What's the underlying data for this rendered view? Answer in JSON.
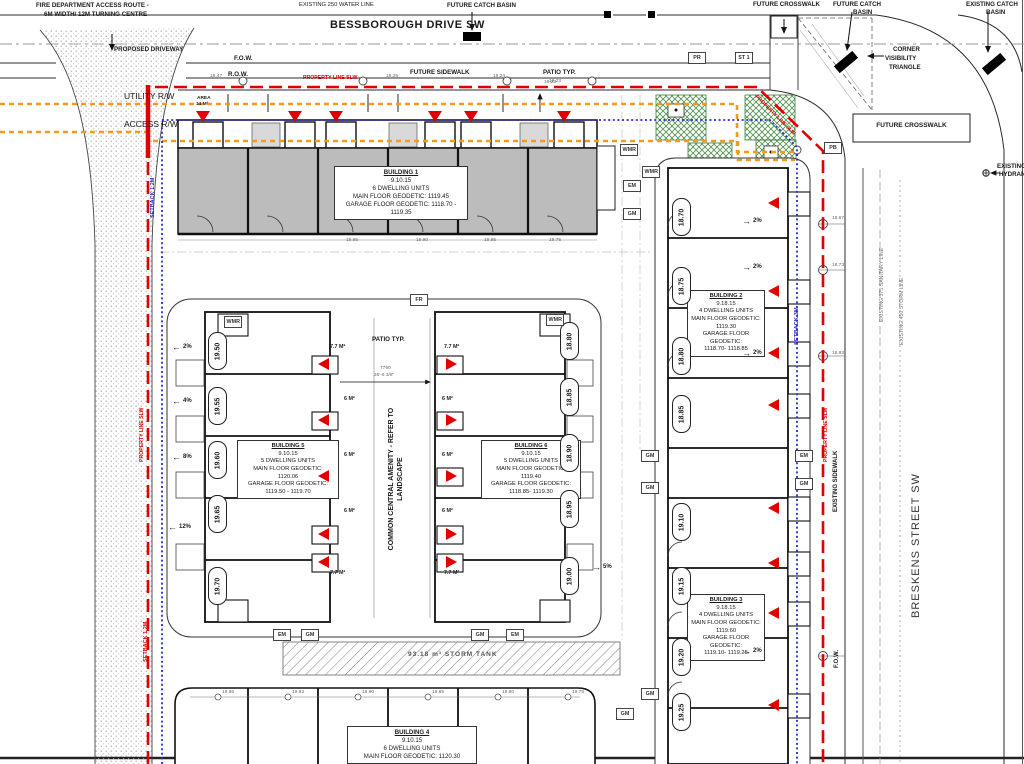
{
  "colors": {
    "property_line": "#e00000",
    "setback_line": "#2a2ad0",
    "rw_line": "#f29a22",
    "building_fill": "#bcbcbc",
    "landscape": "#4d8f4d"
  },
  "streets": {
    "bessborough": "BESSBOROUGH DRIVE SW",
    "breskens": "BRESKENS STREET SW"
  },
  "labels": {
    "fire1": "FIRE DEPARTMENT ACCESS ROUTE -",
    "fire2": "6M WIDTH/ 12M TURNING CENTRE",
    "water": "EXISTING 250 WATER LINE",
    "fcb_top": "FUTURE CATCH BASIN",
    "fcw_top": "FUTURE CROSSWALK",
    "fcb_r1": "FUTURE CATCH",
    "fcb_r2": "BASIN",
    "ecb1": "EXISTING CATCH",
    "ecb2": "BASIN",
    "drive": "PROPOSED DRIVEWAY",
    "cvt1": "CORNER",
    "cvt2": "VISIBILITY",
    "cvt3": "TRIANGLE",
    "fow": "F.O.W.",
    "row": "R.O.W.",
    "fsw": "FUTURE SIDEWALK",
    "patio_top": "PATIO TYP.",
    "patio_elev": "19.23",
    "pl_slw": "PROPERTY LINE SLW",
    "utility": "UTILITY R/W",
    "access": "ACCESS R/W",
    "fcw_right": "FUTURE CROSSWALK",
    "hyd1": "EXISTING",
    "hyd2": "HYDRANT",
    "setback12": "SETBACK 1.2M",
    "setback3": "SETBACK 3M",
    "exist_sw": "EXISTING SIDEWALK",
    "fow2": "F.O.W.",
    "sanitary": "EXISTING 375 SANITARY LINE",
    "stormline": "EXISTING 450 STORM LINE",
    "amen1": "COMMON CENTRAL AMENITY -",
    "amen2": "REFER TO LANDSCAPE",
    "patio_c": "PATIO TYP.",
    "tank": "93.18 m³ STORM TANK",
    "area1": "AREA",
    "area2": "14 M²",
    "dim1": "7790",
    "dim2": "26'-6 3/8\""
  },
  "buildings": {
    "b1": [
      "BUILDING 1",
      "9.10.15",
      "6 DWELLING UNITS",
      "MAIN FLOOR GEODETIC: 1119.45",
      "GARAGE FLOOR GEODETIC: 1118.70 - 1119.35"
    ],
    "b2": [
      "BUILDING 2",
      "9.18.15",
      "4 DWELLING UNITS",
      "MAIN FLOOR GEODETIC:",
      "1119.30",
      "GARAGE FLOOR GEODETIC:",
      "1118.70- 1118.85"
    ],
    "b3": [
      "BUILDING 3",
      "9.18.15",
      "4 DWELLING UNITS",
      "MAIN FLOOR GEODETIC:",
      "1119.60",
      "GARAGE FLOOR GEODETIC:",
      "1119.10- 1119.25"
    ],
    "b4": [
      "BUILDING 4",
      "9.10.15",
      "6 DWELLING UNITS",
      "MAIN FLOOR GEODETIC: 1120.30"
    ],
    "b5": [
      "BUILDING 5",
      "9.10.15",
      "5 DWELLING UNITS",
      "MAIN FLOOR GEODETIC:",
      "1120.06",
      "GARAGE FLOOR GEODETIC:",
      "1119.50 - 1119.70"
    ],
    "b6": [
      "BUILDING 6",
      "9.10.15",
      "5 DWELLING UNITS",
      "MAIN FLOOR GEODETIC:",
      "1119.40",
      "GARAGE FLOOR GEODETIC:",
      "1118.85- 1119.30"
    ]
  },
  "spot_elevations": [
    {
      "v": "19.50",
      "x": 208,
      "y": 332
    },
    {
      "v": "19.55",
      "x": 208,
      "y": 387
    },
    {
      "v": "19.60",
      "x": 208,
      "y": 441
    },
    {
      "v": "19.65",
      "x": 208,
      "y": 495
    },
    {
      "v": "19.70",
      "x": 208,
      "y": 567
    },
    {
      "v": "18.80",
      "x": 560,
      "y": 322
    },
    {
      "v": "18.85",
      "x": 560,
      "y": 378
    },
    {
      "v": "18.90",
      "x": 560,
      "y": 434
    },
    {
      "v": "18.95",
      "x": 560,
      "y": 490
    },
    {
      "v": "19.00",
      "x": 560,
      "y": 557
    },
    {
      "v": "18.70",
      "x": 672,
      "y": 198
    },
    {
      "v": "18.75",
      "x": 672,
      "y": 267
    },
    {
      "v": "18.80",
      "x": 672,
      "y": 337
    },
    {
      "v": "18.85",
      "x": 672,
      "y": 395
    },
    {
      "v": "19.10",
      "x": 672,
      "y": 503
    },
    {
      "v": "19.15",
      "x": 672,
      "y": 567
    },
    {
      "v": "19.20",
      "x": 672,
      "y": 638
    },
    {
      "v": "19.25",
      "x": 672,
      "y": 693
    }
  ],
  "utility_boxes": [
    {
      "v": "PR",
      "x": 688,
      "y": 52
    },
    {
      "v": "ST 1",
      "x": 735,
      "y": 52
    },
    {
      "v": "PB",
      "x": 824,
      "y": 142
    },
    {
      "v": "FR",
      "x": 410,
      "y": 294
    },
    {
      "v": "WMR",
      "x": 620,
      "y": 144
    },
    {
      "v": "WMR",
      "x": 642,
      "y": 166
    },
    {
      "v": "EM",
      "x": 623,
      "y": 180
    },
    {
      "v": "GM",
      "x": 623,
      "y": 208
    },
    {
      "v": "WMR",
      "x": 224,
      "y": 316
    },
    {
      "v": "WMR",
      "x": 546,
      "y": 314
    },
    {
      "v": "EM",
      "x": 273,
      "y": 629
    },
    {
      "v": "GM",
      "x": 301,
      "y": 629
    },
    {
      "v": "GM",
      "x": 471,
      "y": 629
    },
    {
      "v": "EM",
      "x": 506,
      "y": 629
    },
    {
      "v": "GM",
      "x": 641,
      "y": 450
    },
    {
      "v": "GM",
      "x": 641,
      "y": 482
    },
    {
      "v": "EM",
      "x": 795,
      "y": 450
    },
    {
      "v": "GM",
      "x": 795,
      "y": 478
    },
    {
      "v": "GM",
      "x": 616,
      "y": 708
    },
    {
      "v": "GM",
      "x": 641,
      "y": 688
    }
  ],
  "slope_arrows": [
    {
      "v": "2%",
      "x": 172,
      "y": 344,
      "cls": "slope-left"
    },
    {
      "v": "4%",
      "x": 172,
      "y": 398,
      "cls": "slope-left"
    },
    {
      "v": "8%",
      "x": 172,
      "y": 454,
      "cls": "slope-left"
    },
    {
      "v": "12%",
      "x": 168,
      "y": 524,
      "cls": "slope-left"
    },
    {
      "v": "2%",
      "x": 742,
      "y": 218,
      "cls": "slope-right"
    },
    {
      "v": "2%",
      "x": 742,
      "y": 264,
      "cls": "slope-right"
    },
    {
      "v": "2%",
      "x": 742,
      "y": 350,
      "cls": "slope-right"
    },
    {
      "v": "2%",
      "x": 742,
      "y": 648,
      "cls": "slope-right"
    },
    {
      "v": "5%",
      "x": 592,
      "y": 564,
      "cls": "slope-right"
    }
  ],
  "tick_values": [
    {
      "v": "19.47",
      "x": 210,
      "y": 74
    },
    {
      "v": "19.25",
      "x": 386,
      "y": 74
    },
    {
      "v": "19.24",
      "x": 493,
      "y": 74
    },
    {
      "v": "19.23",
      "x": 544,
      "y": 80
    },
    {
      "v": "18.67",
      "x": 832,
      "y": 216
    },
    {
      "v": "18.73",
      "x": 832,
      "y": 263
    },
    {
      "v": "18.83",
      "x": 832,
      "y": 351
    },
    {
      "v": "19.95",
      "x": 346,
      "y": 238
    },
    {
      "v": "19.90",
      "x": 416,
      "y": 238
    },
    {
      "v": "19.85",
      "x": 484,
      "y": 238
    },
    {
      "v": "19.75",
      "x": 549,
      "y": 238
    },
    {
      "v": "19.96",
      "x": 222,
      "y": 690
    },
    {
      "v": "19.93",
      "x": 292,
      "y": 690
    },
    {
      "v": "19.90",
      "x": 362,
      "y": 690
    },
    {
      "v": "19.85",
      "x": 432,
      "y": 690
    },
    {
      "v": "19.80",
      "x": 502,
      "y": 690
    },
    {
      "v": "19.75",
      "x": 572,
      "y": 690
    }
  ],
  "area_labels": [
    {
      "v": "7.7 M²",
      "x": 330,
      "y": 344
    },
    {
      "v": "7.7 M²",
      "x": 444,
      "y": 344
    },
    {
      "v": "7.7 M²",
      "x": 330,
      "y": 570
    },
    {
      "v": "7.7 M²",
      "x": 444,
      "y": 570
    },
    {
      "v": "6 M²",
      "x": 344,
      "y": 396
    },
    {
      "v": "6 M²",
      "x": 344,
      "y": 452
    },
    {
      "v": "6 M²",
      "x": 344,
      "y": 508
    },
    {
      "v": "6 M²",
      "x": 442,
      "y": 396
    },
    {
      "v": "6 M²",
      "x": 442,
      "y": 452
    },
    {
      "v": "6 M²",
      "x": 442,
      "y": 508
    }
  ],
  "entry_markers": [
    {
      "x": 196,
      "y": 111,
      "cls": "down"
    },
    {
      "x": 288,
      "y": 111,
      "cls": "down"
    },
    {
      "x": 329,
      "y": 111,
      "cls": "down"
    },
    {
      "x": 428,
      "y": 111,
      "cls": "down"
    },
    {
      "x": 464,
      "y": 111,
      "cls": "down"
    },
    {
      "x": 557,
      "y": 111,
      "cls": "down"
    },
    {
      "x": 318,
      "y": 358,
      "cls": "left"
    },
    {
      "x": 318,
      "y": 414,
      "cls": "left"
    },
    {
      "x": 318,
      "y": 470,
      "cls": "left"
    },
    {
      "x": 318,
      "y": 528,
      "cls": "left"
    },
    {
      "x": 318,
      "y": 556,
      "cls": "left"
    },
    {
      "x": 446,
      "y": 358,
      "cls": "right"
    },
    {
      "x": 446,
      "y": 414,
      "cls": "right"
    },
    {
      "x": 446,
      "y": 470,
      "cls": "right"
    },
    {
      "x": 446,
      "y": 528,
      "cls": "right"
    },
    {
      "x": 446,
      "y": 556,
      "cls": "right"
    },
    {
      "x": 768,
      "y": 197,
      "cls": "left"
    },
    {
      "x": 768,
      "y": 285,
      "cls": "left"
    },
    {
      "x": 768,
      "y": 347,
      "cls": "left"
    },
    {
      "x": 768,
      "y": 399,
      "cls": "left"
    },
    {
      "x": 768,
      "y": 502,
      "cls": "left"
    },
    {
      "x": 768,
      "y": 557,
      "cls": "left"
    },
    {
      "x": 768,
      "y": 607,
      "cls": "left"
    },
    {
      "x": 768,
      "y": 699,
      "cls": "left"
    }
  ]
}
